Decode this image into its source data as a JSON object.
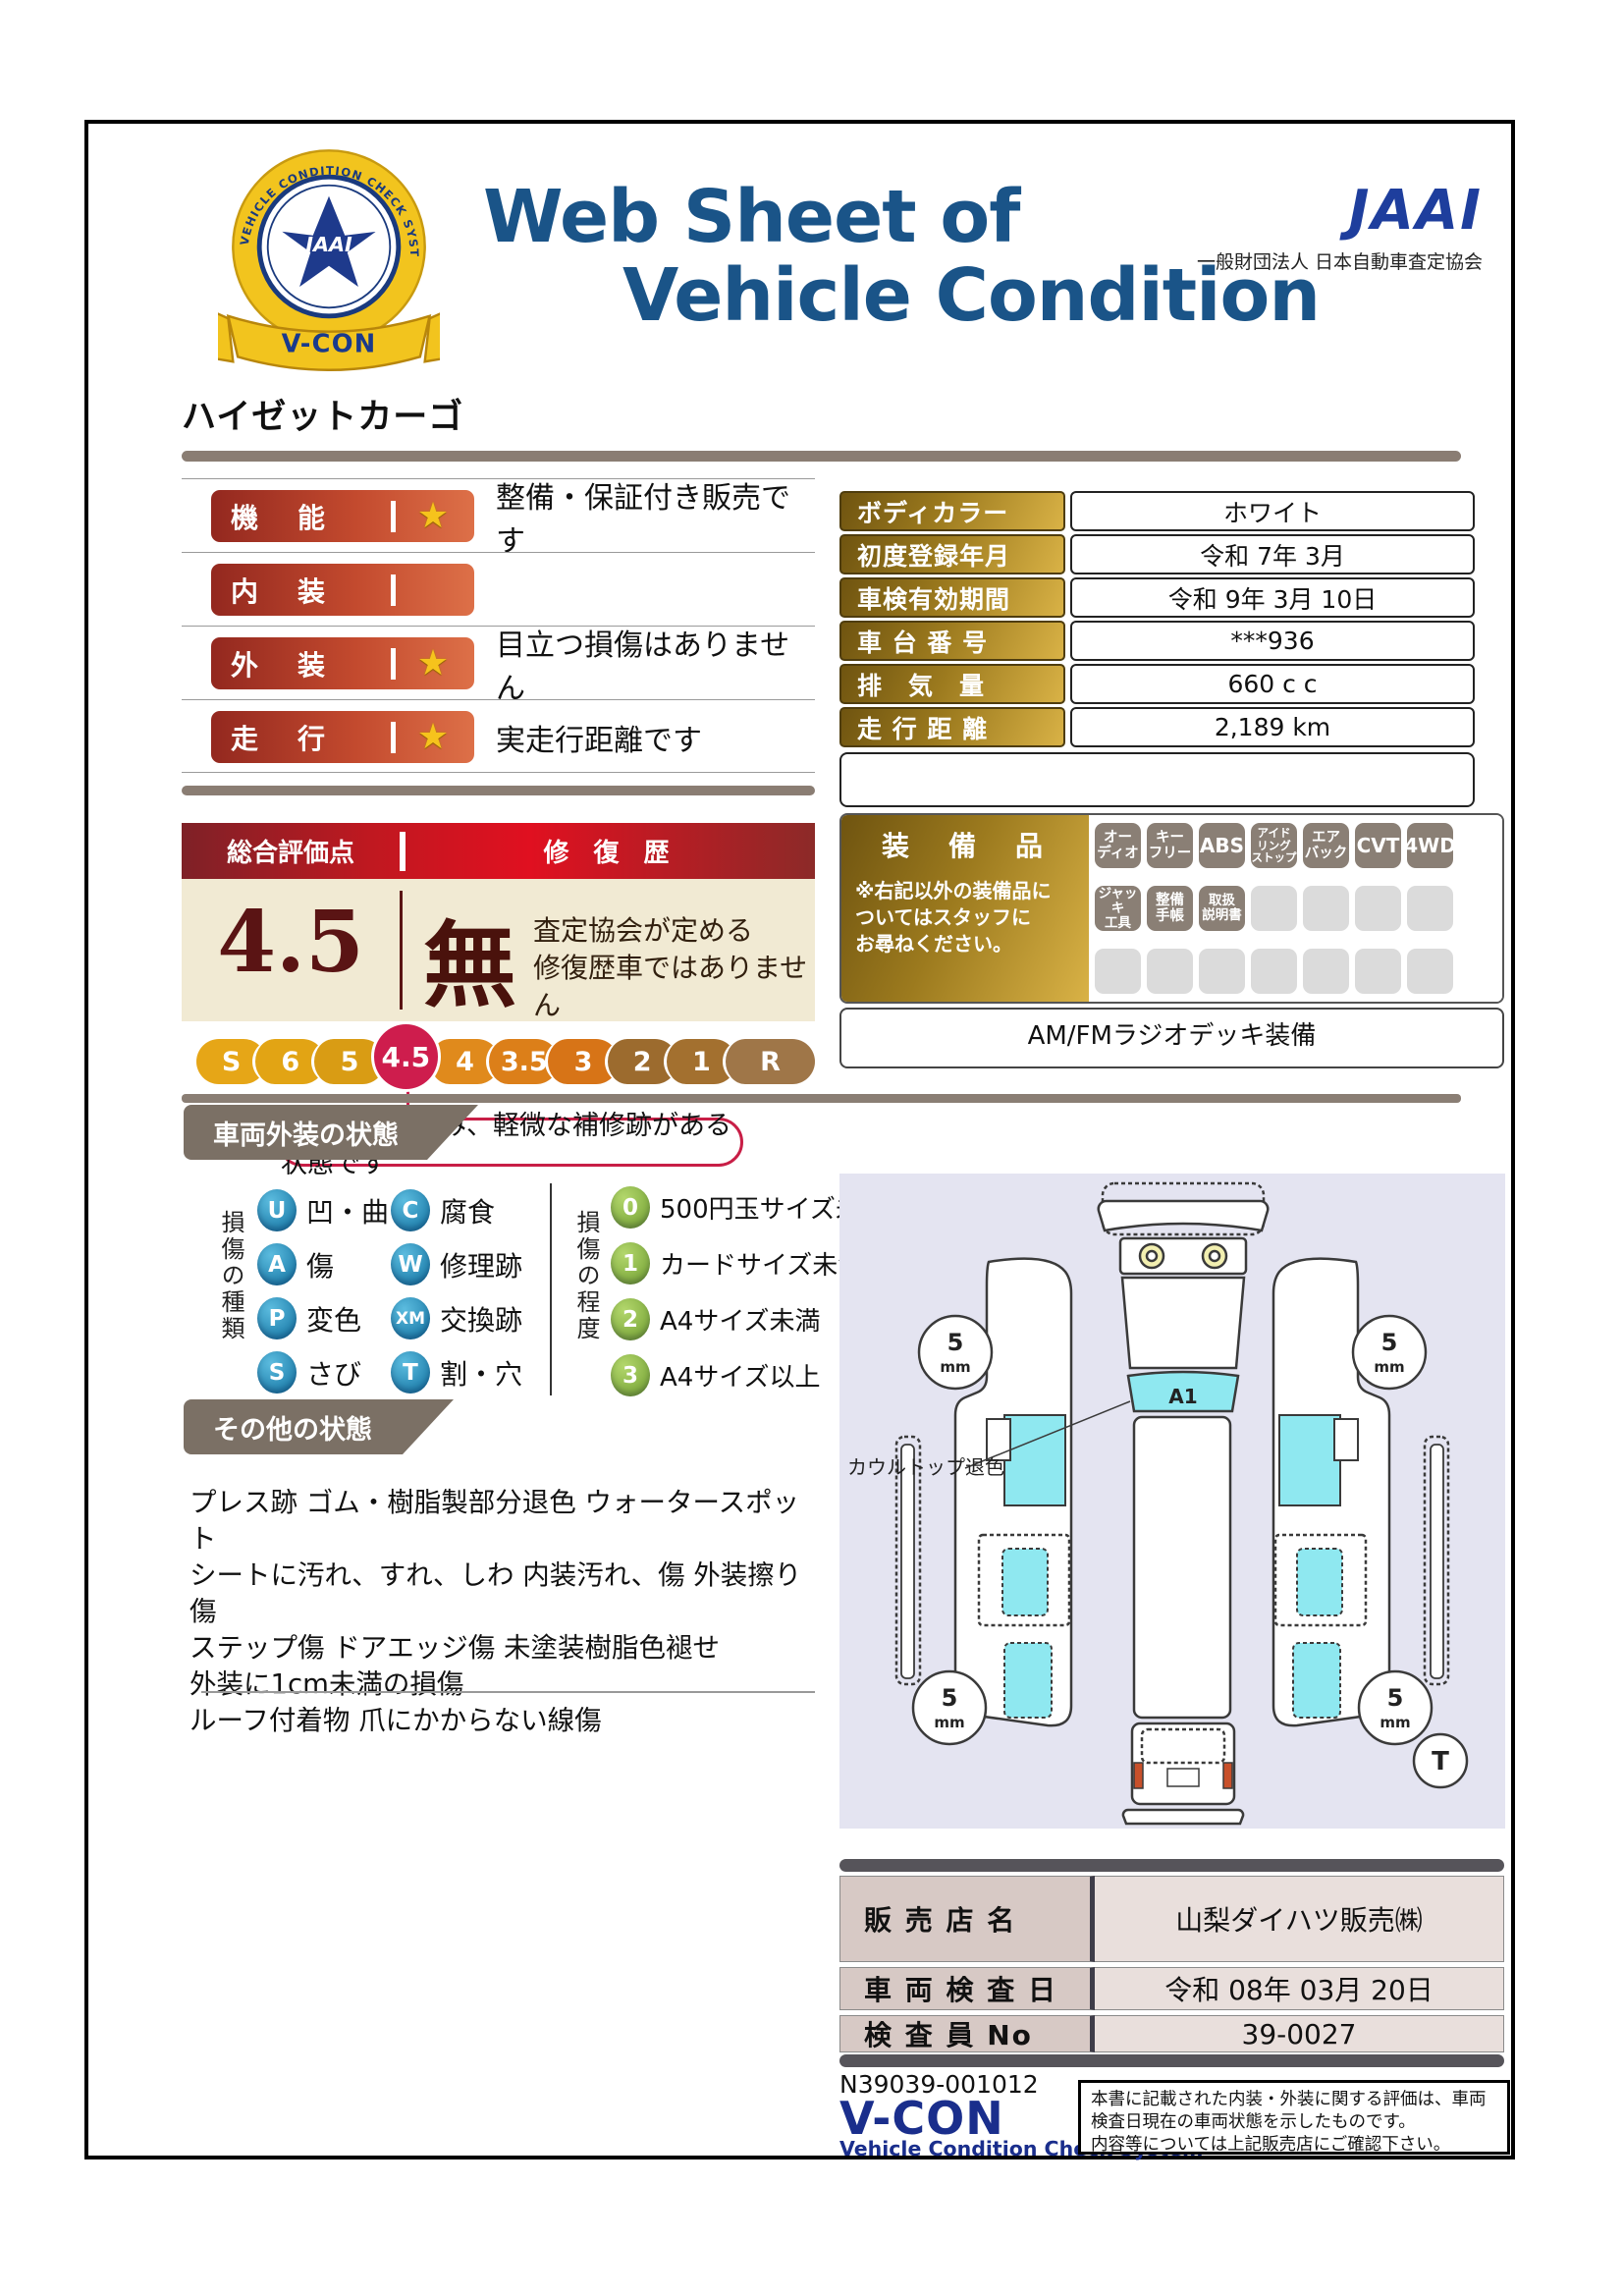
{
  "colors": {
    "title_blue": "#1A5488",
    "jaai_blue": "#1E3E9D",
    "bar_red_dark": "#93281F",
    "bar_red_light": "#DD7048",
    "gold_dark": "#6F5410",
    "gold_light": "#D9B246",
    "score_maroon": "#5A1414",
    "scale_highlight": "#CE1D4D",
    "banner_gray": "#7B7065",
    "panel_lavender": "#E4E4F1",
    "diagram_cyan": "#8FE8F0",
    "badge_taupe": "#8A7F75",
    "legend_blue": "#1C87B8",
    "legend_green": "#7FAF3A"
  },
  "header": {
    "title1": "Web Sheet of",
    "title2": "Vehicle Condition",
    "jaai": "JAAI",
    "jaai_org": "一般財団法人 日本自動車査定協会",
    "badge_star": "JAAI",
    "badge_ring": "VEHICLE CONDITION CHECK SYSTEM",
    "badge_ribbon": "V-CON"
  },
  "vehicle_name": "ハイゼットカーゴ",
  "ratings": [
    {
      "label": "機　能",
      "star": "★",
      "comment": "整備・保証付き販売です"
    },
    {
      "label": "内　装",
      "star": "",
      "comment": ""
    },
    {
      "label": "外　装",
      "star": "★",
      "comment": "目立つ損傷はありません"
    },
    {
      "label": "走　行",
      "star": "★",
      "comment": "実走行距離です"
    }
  ],
  "overall": {
    "header_left": "総合評価点",
    "header_right": "修 復 歴",
    "score": "4.5",
    "repair_flag": "無",
    "repair_note": "査定協会が定める\n修復歴車ではありません"
  },
  "scale": {
    "segments": [
      {
        "label": "S",
        "color": "#E6A617"
      },
      {
        "label": "6",
        "color": "#E2A414"
      },
      {
        "label": "5",
        "color": "#D99C14"
      },
      {
        "label": "4.5",
        "color": "#CE1D4D"
      },
      {
        "label": "4",
        "color": "#E08A1C"
      },
      {
        "label": "3.5",
        "color": "#DC7F19"
      },
      {
        "label": "3",
        "color": "#D77417"
      },
      {
        "label": "2",
        "color": "#9C6B2E"
      },
      {
        "label": "1",
        "color": "#A3702F"
      },
      {
        "label": "R",
        "color": "#9F7648"
      }
    ],
    "selected": "4.5",
    "callout": "小さな傷・凹み、軽微な補修跡がある状態です"
  },
  "info_table": {
    "rows": [
      {
        "label": "ボディカラー",
        "value": "ホワイト"
      },
      {
        "label": "初度登録年月",
        "value": "令和 7年 3月"
      },
      {
        "label": "車検有効期間",
        "value": "令和 9年 3月 10日"
      },
      {
        "label": "車 台 番 号",
        "value": "***936"
      },
      {
        "label": "排　気　量",
        "value": "660 c c"
      },
      {
        "label": "走 行 距 離",
        "value": "2,189 km"
      }
    ]
  },
  "equipment": {
    "label": "装　備　品",
    "note": "※右記以外の装備品に\nついてはスタッフに\nお尋ねください。",
    "rows": [
      [
        "オー\nディオ",
        "キー\nフリー",
        "ABS",
        "アイド\nリング\nストップ",
        "エア\nバック",
        "CVT",
        "4WD"
      ],
      [
        "ジャッキ\n工具",
        "整備\n手帳",
        "取扱\n説明書",
        "",
        "",
        "",
        ""
      ],
      [
        "",
        "",
        "",
        "",
        "",
        "",
        ""
      ]
    ],
    "extra": "AM/FMラジオデッキ装備"
  },
  "exterior": {
    "title": "車両外装の状態",
    "kind_title": "損傷の種類",
    "kinds": [
      {
        "code": "U",
        "label": "凹・曲"
      },
      {
        "code": "C",
        "label": "腐食"
      },
      {
        "code": "A",
        "label": "傷"
      },
      {
        "code": "W",
        "label": "修理跡"
      },
      {
        "code": "P",
        "label": "変色"
      },
      {
        "code": "XM",
        "label": "交換跡"
      },
      {
        "code": "S",
        "label": "さび"
      },
      {
        "code": "T",
        "label": "割・穴"
      }
    ],
    "degree_title": "損傷の程度",
    "degrees": [
      {
        "code": "0",
        "label": "500円玉サイズ未満"
      },
      {
        "code": "1",
        "label": "カードサイズ未満"
      },
      {
        "code": "2",
        "label": "A4サイズ未満"
      },
      {
        "code": "3",
        "label": "A4サイズ以上"
      }
    ]
  },
  "other": {
    "title": "その他の状態",
    "lines": "プレス跡 ゴム・樹脂製部分退色 ウォータースポット\nシートに汚れ、すれ、しわ 内装汚れ、傷 外装擦り傷\nステップ傷 ドアエッジ傷 未塗装樹脂色褪せ\n外装に1cm未満の損傷\nルーフ付着物 爪にかからない線傷"
  },
  "diagram": {
    "annotation": "カウルトップ退色",
    "marker": "A1",
    "tread": "5",
    "tread_unit": "mm",
    "corner_mark": "T"
  },
  "dealer": {
    "rows": [
      {
        "label": "販 売 店 名",
        "value": "山梨ダイハツ販売㈱"
      },
      {
        "label": "車 両 検 査 日",
        "value": "令和 08年 03月 20日"
      },
      {
        "label": "検 査 員 No",
        "value": "39-0027"
      }
    ]
  },
  "footer": {
    "serial": "N39039-001012",
    "vcon": "V-CON",
    "vcon_sub": "Vehicle Condition Check System",
    "note": "本書に記載された内装・外装に関する評価は、車両\n検査日現在の車両状態を示したものです。\n内容等については上記販売店にご確認下さい。"
  }
}
